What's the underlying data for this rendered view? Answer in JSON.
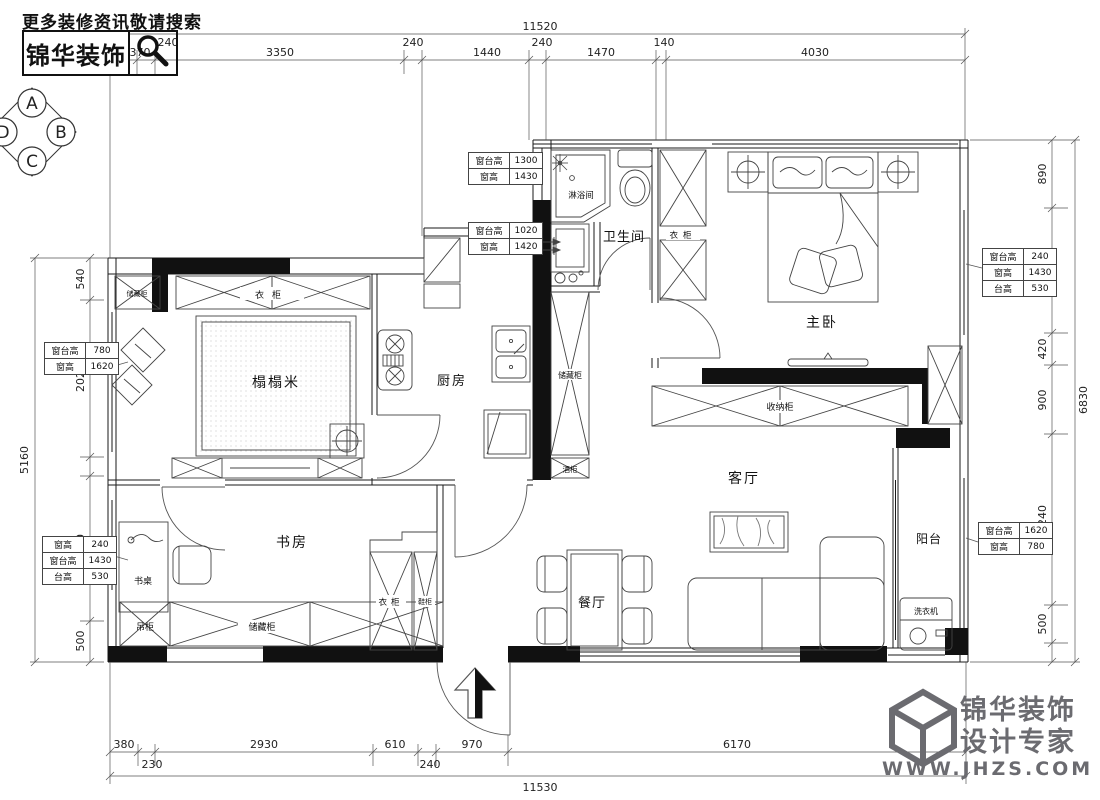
{
  "header": {
    "search_hint": "更多装修资讯敬请搜索",
    "brand": "锦华装饰"
  },
  "compass": {
    "n": "A",
    "e": "B",
    "s": "C",
    "w": "D"
  },
  "watermark": {
    "brand": "锦华装饰",
    "tagline": "设计专家",
    "site": "WWW.JHZS.COM"
  },
  "rooms": {
    "tatami": "榻榻米",
    "kitchen": "厨房",
    "bathroom": "卫生间",
    "shower": "淋浴间",
    "master_bedroom": "主卧",
    "study": "书房",
    "living": "客厅",
    "dining": "餐厅",
    "balcony": "阳台"
  },
  "cabinets": {
    "wardrobe": "衣柜",
    "storage": "储藏柜",
    "shoe": "鞋柜",
    "hanging": "吊柜",
    "desk": "书桌",
    "wine": "酒柜",
    "collect": "收纳柜",
    "washer": "洗衣机"
  },
  "window_tables": [
    {
      "rows": [
        [
          "窗台高",
          "1300"
        ],
        [
          "窗高",
          "1430"
        ]
      ]
    },
    {
      "rows": [
        [
          "窗台高",
          "1020"
        ],
        [
          "窗高",
          "1420"
        ]
      ]
    },
    {
      "rows": [
        [
          "窗台高",
          "780"
        ],
        [
          "窗高",
          "1620"
        ]
      ]
    },
    {
      "rows": [
        [
          "窗高",
          "240"
        ],
        [
          "窗台高",
          "1430"
        ],
        [
          "台高",
          "530"
        ]
      ]
    },
    {
      "rows": [
        [
          "窗台高",
          "240"
        ],
        [
          "窗高",
          "1430"
        ],
        [
          "台高",
          "530"
        ]
      ]
    },
    {
      "rows": [
        [
          "窗台高",
          "1620"
        ],
        [
          "窗高",
          "780"
        ]
      ]
    }
  ],
  "dims": {
    "top": {
      "overall": "11520",
      "segments": [
        "370",
        "240",
        "3350",
        "240",
        "1440",
        "240",
        "1470",
        "140",
        "4030"
      ]
    },
    "bottom": {
      "overall": "11530",
      "segments": [
        "380",
        "230",
        "2930",
        "610",
        "240",
        "970",
        "6170"
      ]
    },
    "left": {
      "overall": "5160",
      "segments": [
        "540",
        "2020",
        "1860",
        "500"
      ]
    },
    "right": {
      "overall": "6830",
      "segments": [
        "890",
        "1650",
        "420",
        "900",
        "2240",
        "500"
      ]
    }
  }
}
